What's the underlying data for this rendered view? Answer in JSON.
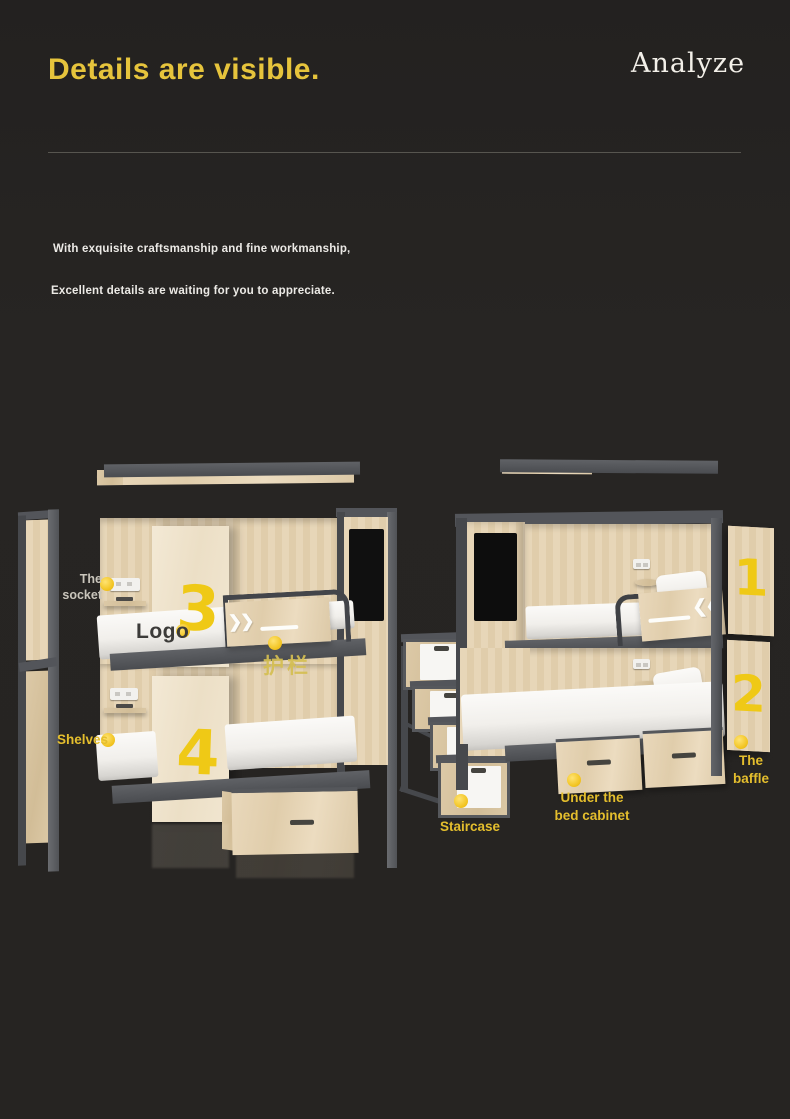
{
  "theme": {
    "background": "#262422",
    "title_yellow": "#e6c43c",
    "label_yellow": "#e4be2d",
    "number_yellow": "#efc916",
    "dot_yellow": "#f2c421",
    "wood": "#e5d3b3",
    "metal_gray": "#53555a",
    "text_light": "#eceae6"
  },
  "header": {
    "title": "Details are visible.",
    "brand": "Analyze"
  },
  "intro": {
    "line1": "With exquisite craftsmanship and fine workmanship,",
    "line2": "Excellent details are waiting for you to appreciate."
  },
  "callouts": {
    "socket": "The\nsocket",
    "logo": "Logo",
    "guardrail": "护栏",
    "shelves": "Shelves",
    "staircase": "Staircase",
    "under_bed": "Under the\nbed cabinet",
    "baffle": "The\nbaffle"
  },
  "numbers": {
    "left_top": "3",
    "left_bottom": "4",
    "right_top": "1",
    "right_bottom": "2"
  },
  "icons": {
    "guardrail_left_chevrons": "❯❯",
    "guardrail_right_chevrons": "❮❮"
  }
}
